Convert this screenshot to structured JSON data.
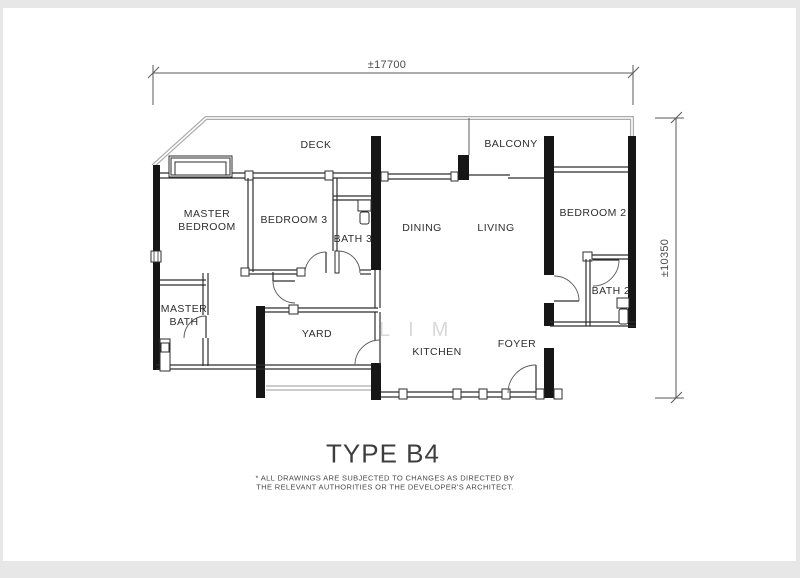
{
  "window": {
    "frame_color": "#e7e7e7",
    "page_color": "#ffffff"
  },
  "plan": {
    "title": "TYPE B4",
    "disclaimer": {
      "line1": "* ALL DRAWINGS ARE SUBJECTED TO CHANGES AS DIRECTED BY",
      "line2": "THE RELEVANT AUTHORITIES OR THE DEVELOPER'S ARCHITECT."
    },
    "dimensions": {
      "width_label": "±17700",
      "height_label": "±10350"
    },
    "watermark": "LIM",
    "rooms": [
      {
        "label": "DECK"
      },
      {
        "label": "BALCONY"
      },
      {
        "label": "MASTER BEDROOM"
      },
      {
        "label": "BEDROOM 3"
      },
      {
        "label": "BATH 3"
      },
      {
        "label": "DINING"
      },
      {
        "label": "LIVING"
      },
      {
        "label": "BEDROOM 2"
      },
      {
        "label": "MASTER BATH"
      },
      {
        "label": "YARD"
      },
      {
        "label": "KITCHEN"
      },
      {
        "label": "FOYER"
      },
      {
        "label": "BATH 2"
      }
    ],
    "colors": {
      "wall": "#161616",
      "interior_line": "#2e2e2e",
      "deck_outline": "#ababab",
      "dimension_line": "#5a5a5a",
      "label_text": "#2e2e2e",
      "watermark_text": "#d8d8d8"
    }
  }
}
